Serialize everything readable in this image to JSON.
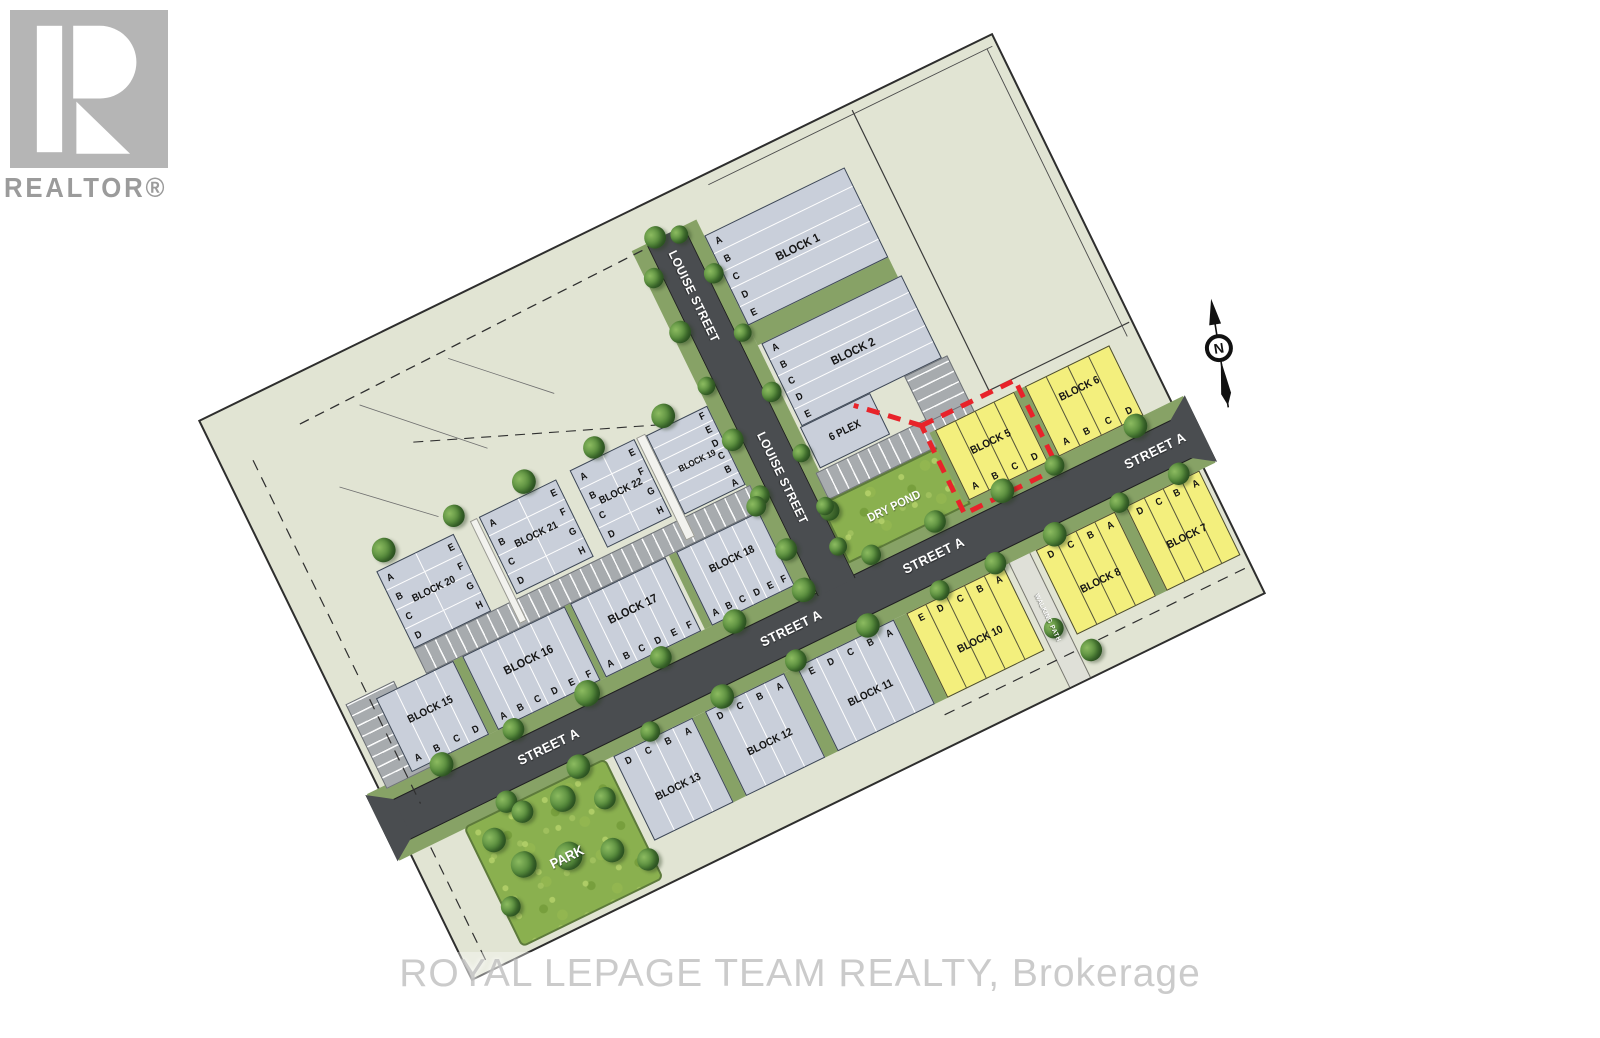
{
  "logo": {
    "r_glyph": "R",
    "label": "REALTOR®"
  },
  "watermark": "ROYAL LEPAGE TEAM REALTY, Brokerage",
  "compass": {
    "north_label": "N"
  },
  "streets": {
    "street_a": "STREET A",
    "louise": "LOUISE STREET",
    "walking_path": "WALKING PATH"
  },
  "areas": {
    "dry_pond": "DRY POND",
    "park": "PARK",
    "six_plex": "6 PLEX"
  },
  "colors": {
    "lot_yellow": "#f3ef7d",
    "lot_gray": "#c9cfda",
    "road_asphalt": "#4a4d50",
    "field": "#e1e4d3",
    "verge_green": "#87a266",
    "pond_green": "#8ab04f",
    "highlight_red": "#e8232a"
  },
  "blocks": [
    {
      "id": "block-1",
      "label": "BLOCK 1",
      "style": "gray",
      "highlighted": false,
      "lots": [
        "A",
        "B",
        "C",
        "D",
        "E"
      ]
    },
    {
      "id": "block-2",
      "label": "BLOCK 2",
      "style": "gray",
      "highlighted": false,
      "lots": [
        "A",
        "B",
        "C",
        "D",
        "E"
      ]
    },
    {
      "id": "block-5",
      "label": "BLOCK 5",
      "style": "yellow",
      "highlighted": true,
      "lots": [
        "A",
        "B",
        "C",
        "D"
      ]
    },
    {
      "id": "block-6",
      "label": "BLOCK 6",
      "style": "yellow",
      "highlighted": false,
      "lots": [
        "A",
        "B",
        "C",
        "D"
      ]
    },
    {
      "id": "block-7",
      "label": "BLOCK 7",
      "style": "yellow",
      "highlighted": false,
      "lots": [
        "D",
        "C",
        "B",
        "A"
      ]
    },
    {
      "id": "block-8",
      "label": "BLOCK 8",
      "style": "yellow",
      "highlighted": false,
      "lots": [
        "D",
        "C",
        "B",
        "A"
      ]
    },
    {
      "id": "block-10",
      "label": "BLOCK 10",
      "style": "yellow",
      "highlighted": false,
      "lots": [
        "E",
        "D",
        "C",
        "B",
        "A"
      ]
    },
    {
      "id": "block-11",
      "label": "BLOCK 11",
      "style": "gray",
      "highlighted": false,
      "lots": [
        "E",
        "D",
        "C",
        "B",
        "A"
      ]
    },
    {
      "id": "block-12",
      "label": "BLOCK 12",
      "style": "gray",
      "highlighted": false,
      "lots": [
        "D",
        "C",
        "B",
        "A"
      ]
    },
    {
      "id": "block-13",
      "label": "BLOCK 13",
      "style": "gray",
      "highlighted": false,
      "lots": [
        "D",
        "C",
        "B",
        "A"
      ]
    },
    {
      "id": "block-15",
      "label": "BLOCK 15",
      "style": "gray",
      "highlighted": false,
      "lots": [
        "A",
        "B",
        "C",
        "D"
      ]
    },
    {
      "id": "block-16",
      "label": "BLOCK 16",
      "style": "gray",
      "highlighted": false,
      "lots": [
        "A",
        "B",
        "C",
        "D",
        "E",
        "F"
      ]
    },
    {
      "id": "block-17",
      "label": "BLOCK 17",
      "style": "gray",
      "highlighted": false,
      "lots": [
        "A",
        "B",
        "C",
        "D",
        "E",
        "F"
      ]
    },
    {
      "id": "block-18",
      "label": "BLOCK 18",
      "style": "gray",
      "highlighted": false,
      "lots": [
        "A",
        "B",
        "C",
        "D",
        "E",
        "F"
      ]
    },
    {
      "id": "block-19",
      "label": "BLOCK 19",
      "style": "gray",
      "highlighted": false,
      "lots": [
        "F",
        "E",
        "D",
        "C",
        "B",
        "A"
      ]
    },
    {
      "id": "block-20",
      "label": "BLOCK 20",
      "style": "gray",
      "highlighted": false,
      "lots": [
        "A",
        "B",
        "C",
        "D",
        "E",
        "F",
        "G",
        "H"
      ]
    },
    {
      "id": "block-21",
      "label": "BLOCK 21",
      "style": "gray",
      "highlighted": false,
      "lots": [
        "A",
        "B",
        "C",
        "D",
        "E",
        "F",
        "G",
        "H"
      ]
    },
    {
      "id": "block-22",
      "label": "BLOCK 22",
      "style": "gray",
      "highlighted": false,
      "lots": [
        "A",
        "B",
        "C",
        "D",
        "E",
        "F",
        "G",
        "H"
      ]
    }
  ]
}
